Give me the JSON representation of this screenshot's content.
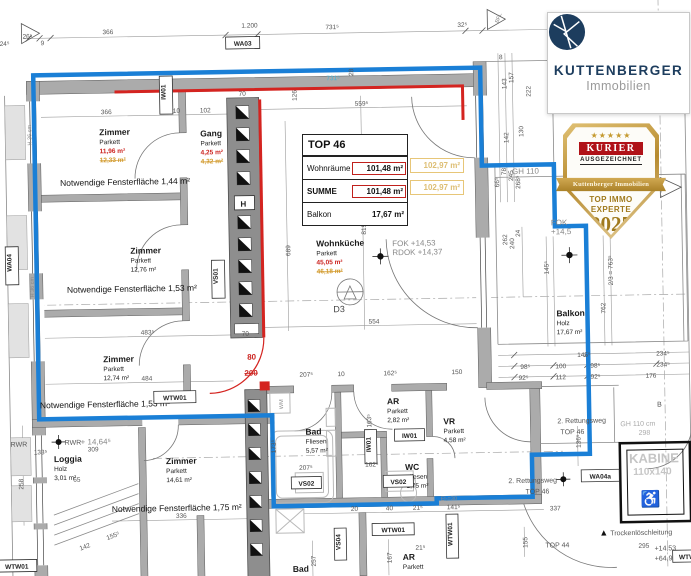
{
  "colors": {
    "outline_blue": "#1a7fd6",
    "change_red": "#d42420",
    "revised_orange": "#d29a2c",
    "brand_navy": "#1d3d5e",
    "kurier_red": "#b01218",
    "badge_gold": "#b68a2e"
  },
  "brand": {
    "name": "KUTTENBERGER",
    "subtitle": "Immobilien"
  },
  "badge": {
    "stars": "★★★★★",
    "kurier": "KURIER",
    "award": "AUSGEZEICHNET",
    "ribbon": "Kuttenberger Immobilien",
    "line1": "TOP IMMO",
    "line2": "EXPERTE",
    "year": "2025",
    "org": "IMWF"
  },
  "table": {
    "title": "TOP 46",
    "rows": [
      {
        "label": "Wohnräume",
        "value": "101,48 m²",
        "revised": "102,97 m²"
      },
      {
        "label": "SUMME",
        "value": "101,48 m²",
        "revised": "102,97 m²"
      },
      {
        "label": "Balkon",
        "value": "17,67 m²"
      }
    ]
  },
  "rooms": {
    "zimmer1": {
      "name": "Zimmer",
      "type": "Parkett",
      "area": "11,96 m²",
      "revised": "12,33 m²"
    },
    "gang": {
      "name": "Gang",
      "type": "Parkett",
      "area": "4,25 m²",
      "revised": "4,32 m²"
    },
    "zimmer2": {
      "name": "Zimmer",
      "type": "Parkett",
      "area": "12,76 m²"
    },
    "zimmer3": {
      "name": "Zimmer",
      "type": "Parkett",
      "area": "12,74 m²"
    },
    "zimmer4": {
      "name": "Zimmer",
      "type": "Parkett",
      "area": "14,61 m²"
    },
    "loggia": {
      "name": "Loggia",
      "type": "Holz",
      "area": "3,01 m²"
    },
    "wohnkueche": {
      "name": "Wohnküche",
      "type": "Parkett",
      "area": "45,05 m²",
      "revised": "46,18 m²"
    },
    "bad": {
      "name": "Bad",
      "type": "Fliesen",
      "area": "5,57 m²"
    },
    "ar": {
      "name": "AR",
      "type": "Parkett",
      "area": "2,82 m²"
    },
    "vr": {
      "name": "VR",
      "type": "Parkett",
      "area": "4,58 m²"
    },
    "wc": {
      "name": "WC",
      "type": "Fliesen",
      "area": "1,75 m²"
    },
    "balkon": {
      "name": "Balkon",
      "type": "Holz",
      "area": "17,67 m²"
    },
    "ar2": {
      "name": "AR",
      "type": "Parkett"
    },
    "bad2": {
      "name": "Bad"
    }
  },
  "notes": {
    "fenster1": "Notwendige Fensterfläche 1,44 m²",
    "fenster2": "Notwendige Fensterfläche 1,53 m²",
    "fenster3": "Notwendige Fensterfläche 1,53 m²",
    "fenster4": "Notwendige Fensterfläche 1,75 m²",
    "fok": "FOK +14,53",
    "rdok": "RDOK +14,37",
    "fok2": "FOK",
    "fok2v": "+14,5",
    "gh110": "GH 110",
    "gh110cm": "GH 110 cm",
    "rettung": "2. Rettungsweg",
    "top46": "TOP 46",
    "trocken": "Trockenlöschleitung",
    "kabine": "KABINE",
    "kabinesize": "110x140",
    "top44": "TOP 44",
    "lvl1": "+14,53",
    "lvl2": "+64,90 D",
    "rwr": "RWR",
    "rwrplus": "+ 14,64⁵",
    "el": "El₂=30",
    "brh": "H 36 cm"
  },
  "labels": {
    "wa03": "WA03",
    "wa04": "WA04",
    "wa04a": "WA04a",
    "iw01": "IW01",
    "wtw01": "WTW01",
    "vs01": "VS01",
    "vs02": "VS02",
    "vs04": "VS04",
    "h": "H",
    "wm": "WM",
    "b": "B",
    "bfl": "BFL",
    "d3": "D3"
  },
  "icons": {
    "wheelchair": "♿",
    "hydrant": "▲"
  },
  "dims": [
    "1.200",
    "366",
    "731⁵",
    "32⁵",
    "24⁵",
    "26⁵",
    "9",
    "366",
    "10",
    "102",
    "731⁵",
    "559⁵",
    "126",
    "28",
    "8",
    "143",
    "157",
    "222",
    "142",
    "130",
    "66⁵",
    "78",
    "245",
    "268⁵",
    "262",
    "240",
    "24",
    "689",
    "819",
    "554",
    "483⁵",
    "484",
    "70",
    "70",
    "80",
    "200",
    "207⁵",
    "10",
    "162⁵",
    "150",
    "163⁵",
    "173⁵",
    "207⁵",
    "162⁵",
    "336",
    "65",
    "142",
    "155⁵",
    "133⁵",
    "309",
    "258",
    "98⁵",
    "100",
    "98⁵",
    "234⁵",
    "92⁵",
    "112",
    "92⁵",
    "176",
    "145⁵",
    "762",
    "2/3 = 763⁵",
    "337",
    "155",
    "295",
    "136⁵",
    "20",
    "40",
    "21⁵",
    "141⁵",
    "21⁵",
    "257",
    "167",
    "298",
    "145⁵",
    "234⁵"
  ]
}
